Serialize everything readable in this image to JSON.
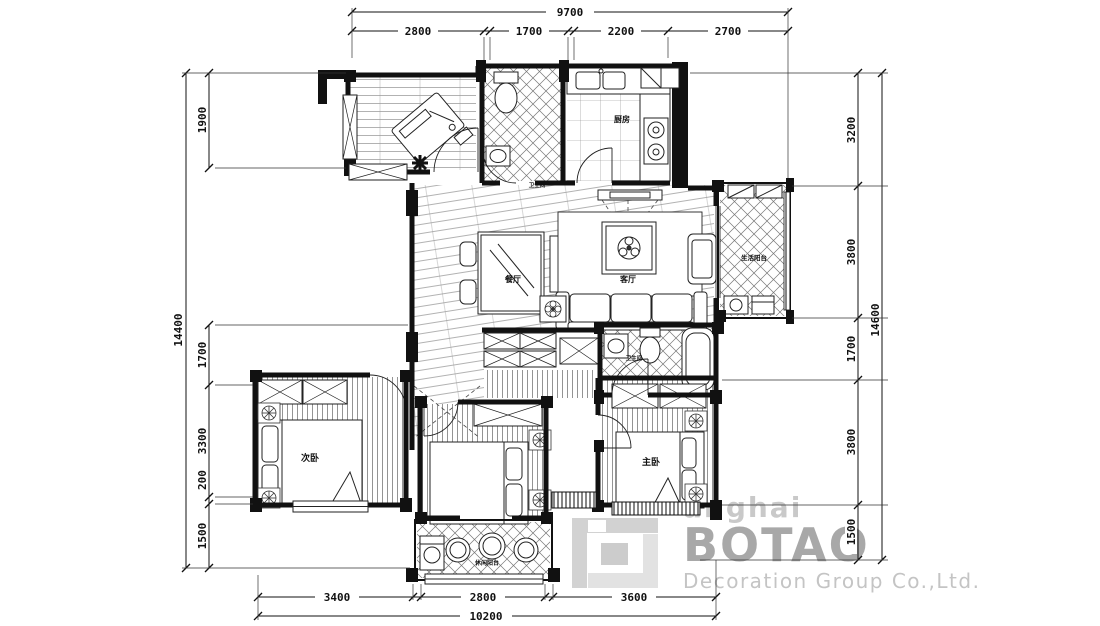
{
  "watermark": {
    "partial_text": "anghai",
    "brand": "BOTAO",
    "subtitle": "Decoration Group Co.,Ltd."
  },
  "rooms": {
    "dining": "餐厅",
    "living": "客厅",
    "kitchen": "厨房",
    "bath_top": "卫生间",
    "bath_mid": "卫生间",
    "bedroom_left": "次卧",
    "bedroom_master": "主卧",
    "balcony_right": "生活阳台",
    "balcony_bottom": "休闲阳台"
  },
  "dimensions": {
    "top": {
      "overall": "9700",
      "segments": [
        "2800",
        "1700",
        "2200",
        "2700"
      ]
    },
    "left": {
      "overall": "14400",
      "segments": [
        "1900",
        "1700",
        "3300",
        "200",
        "1500"
      ]
    },
    "right": {
      "overall": "14600",
      "segments": [
        "3200",
        "3800",
        "1700",
        "3800",
        "1500"
      ]
    },
    "bottom": {
      "overall": "10200",
      "segments": [
        "3400",
        "2800",
        "3600"
      ]
    }
  },
  "colors": {
    "line": "#111111",
    "watermark_text": "#c9c9c9",
    "watermark_brand": "#a8a8a8",
    "watermark_logo": "#d8d8d8",
    "background": "#ffffff"
  }
}
